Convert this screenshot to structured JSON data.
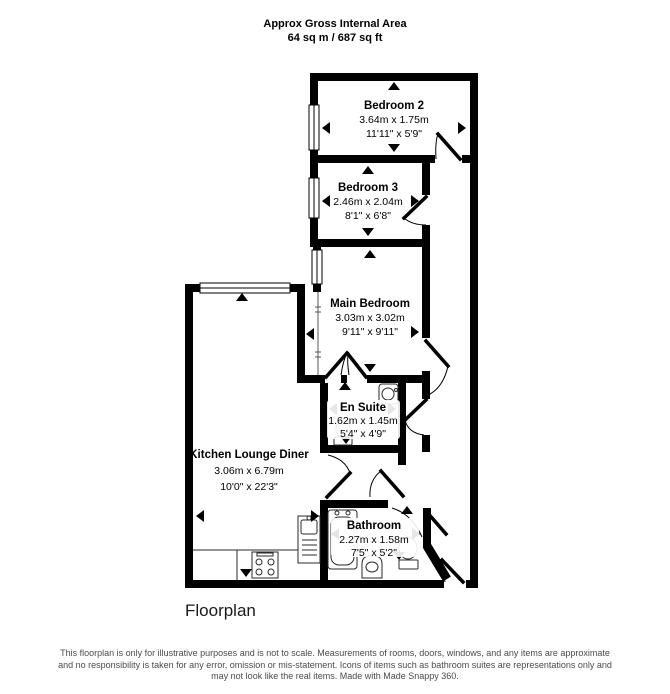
{
  "header": {
    "title": "Approx Gross Internal Area",
    "area": "64 sq m / 687 sq ft"
  },
  "rooms": {
    "bedroom2": {
      "name": "Bedroom 2",
      "metric": "3.64m x 1.75m",
      "imperial": "11'11\" x 5'9\""
    },
    "bedroom3": {
      "name": "Bedroom 3",
      "metric": "2.46m x 2.04m",
      "imperial": "8'1\" x 6'8\""
    },
    "main_bedroom": {
      "name": "Main Bedroom",
      "metric": "3.03m x 3.02m",
      "imperial": "9'11\" x 9'11\""
    },
    "en_suite": {
      "name": "En Suite",
      "metric": "1.62m x 1.45m",
      "imperial": "5'4\" x 4'9\""
    },
    "kitchen": {
      "name": "Kitchen Lounge Diner",
      "metric": "3.06m x 6.79m",
      "imperial": "10'0\" x 22'3\""
    },
    "bathroom": {
      "name": "Bathroom",
      "metric": "2.27m x 1.58m",
      "imperial": "7'5\" x 5'2\""
    }
  },
  "caption": "Floorplan",
  "footer": {
    "line1": "This floorplan is only for illustrative purposes and is not to scale. Measurements of rooms, doors, windows, and any items are approximate",
    "line2": "and no responsibility is taken for any error, omission or mis-statement. Icons of items such as bathroom suites are representations only and",
    "line3": "may not look like the real items. Made with Made Snappy 360."
  },
  "colors": {
    "wall": "#000000",
    "background": "#ffffff"
  }
}
